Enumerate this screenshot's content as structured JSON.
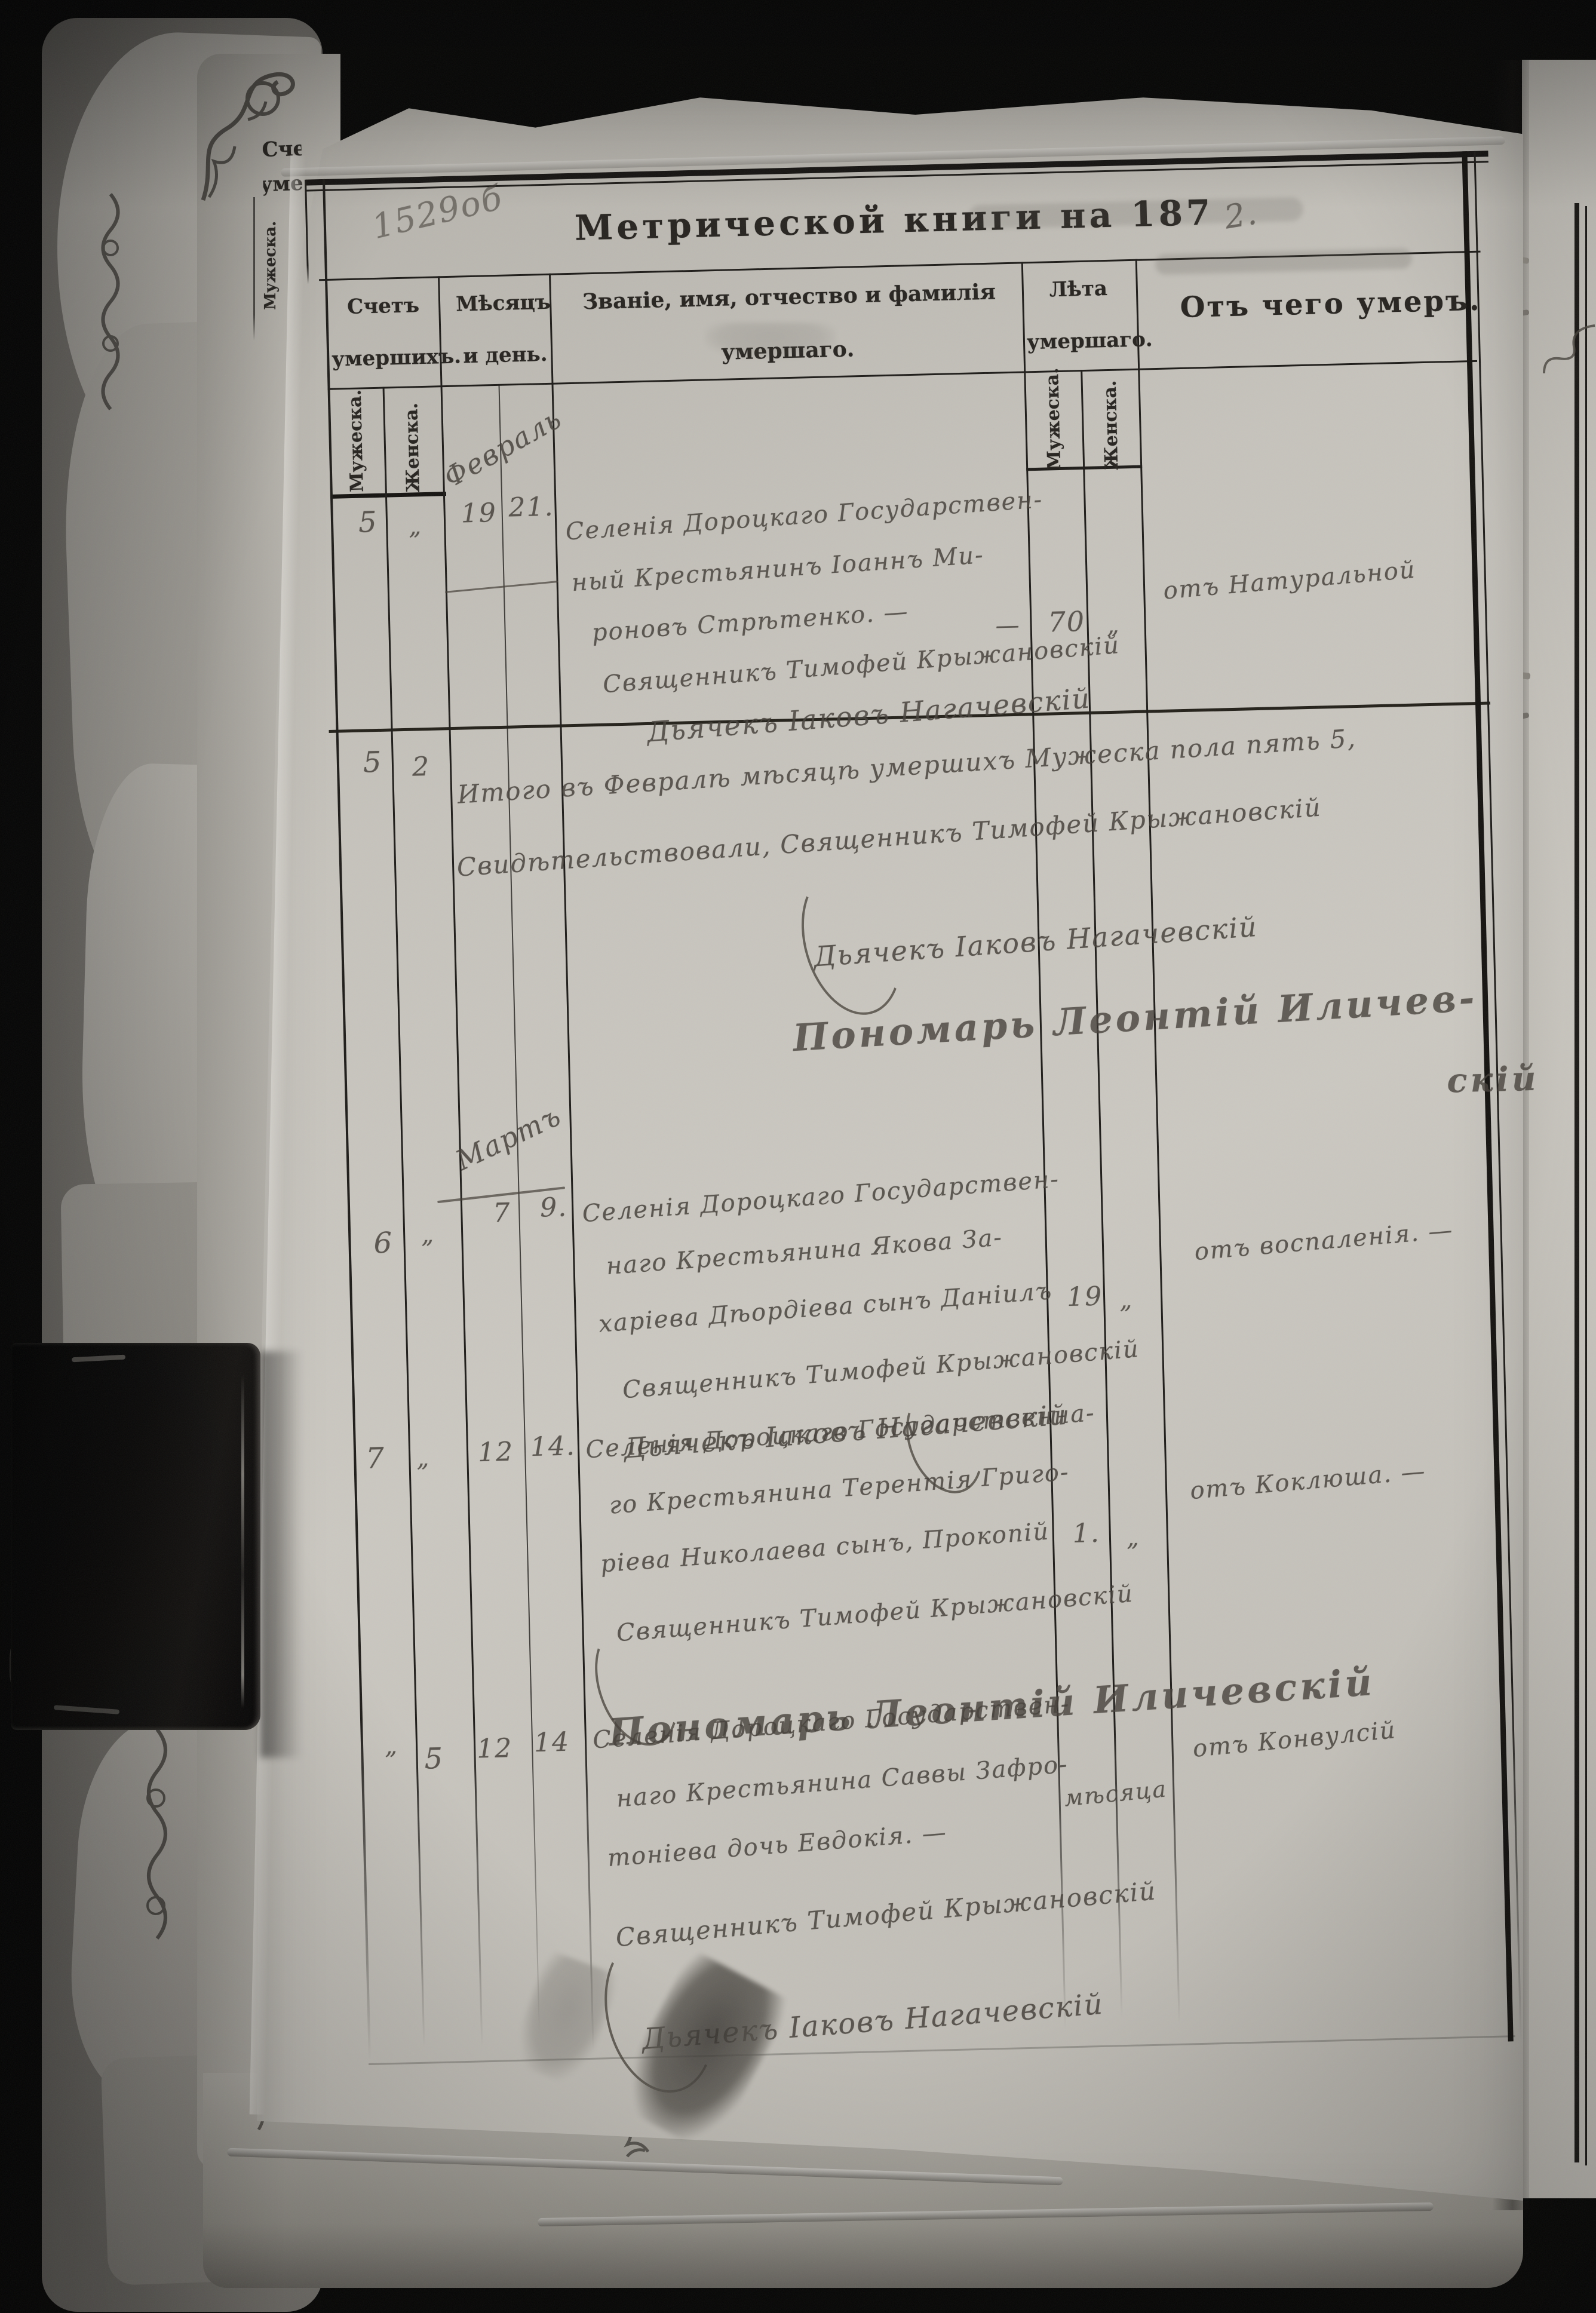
{
  "document_type": "metrical-book-death-register-photo",
  "page": {
    "folio_mark": "1529об",
    "title": "Метрической книги на 187",
    "title_year_handwritten": "2."
  },
  "header": {
    "count_l1": "Счетъ",
    "count_l2": "умершихъ.",
    "date_l1": "Мѣсяцъ",
    "date_l2": "и день.",
    "name_l1": "Званіе, имя, отчество и фамилія",
    "name_l2": "умершаго.",
    "age_l1": "Лѣта",
    "age_l2": "умершаго.",
    "cause": "Отъ чего умеръ.",
    "sub_male": "Мужеска.",
    "sub_female": "Женска."
  },
  "months": {
    "february": "Февраль",
    "march": "Мартъ"
  },
  "entries": {
    "feb1": {
      "no_male": "5",
      "no_female": "„",
      "day1": "19",
      "day2": "21.",
      "l1": "Селенія Дороцкаго Государствен-",
      "l2": "ный Крестьянинъ Іоаннъ Ми-",
      "l3": "роновъ Стрѣтенко. —",
      "dash": "—",
      "age_male": "70",
      "age_female": "„",
      "cause": "отъ Натуральной",
      "priest": "Священникъ Тимофей Крыжановскій",
      "clerk": "Дьячекъ Іаковъ Нагачевскій"
    },
    "feb_total": {
      "no_male": "5",
      "no_female": "2",
      "l1": "Итого въ Февралѣ мѣсяцѣ умершихъ Мужеска пола пять 5,",
      "l2": "Свидѣтельствовали, Священникъ Тимофей Крыжановскій",
      "clerk": "Дьячекъ Іаковъ Нагачевскій",
      "sexton_l1": "Пономарь Леонтій Иличев-",
      "sexton_l2": "скій"
    },
    "mar1": {
      "no_male": "6",
      "no_female": "„",
      "day1": "7",
      "day2": "9.",
      "l1": "Селенія Дороцкаго Государствен-",
      "l2": "наго Крестьянина Якова За-",
      "l3": "харіева Дѣордіева сынъ Даніилъ",
      "age_male": "19",
      "age_female": "„",
      "cause": "отъ воспаленія. —",
      "priest": "Священникъ Тимофей Крыжановскій",
      "clerk": "Дьячекъ Іаковъ Нагачевскій"
    },
    "mar2": {
      "no_male": "7",
      "no_female": "„",
      "day1": "12",
      "day2": "14.",
      "l1": "Селенія Дороцкаго Государственна-",
      "l2": "го Крестьянина Терентія Григо-",
      "l3": "ріева Николаева сынъ, Прокопій",
      "age_male": "1.",
      "age_female": "„",
      "cause": "отъ Коклюша. —",
      "priest": "Священникъ Тимофей Крыжановскій",
      "sexton": "Пономарь Леонтій Иличевскій"
    },
    "mar3": {
      "no_male": "„",
      "no_female": "5",
      "day1": "12",
      "day2": "14",
      "l1": "Селенія Дороцкаго Государствен-",
      "l2": "наго Крестьянина Саввы Зафро-",
      "l3": "тоніева дочь Евдокія. —",
      "age_written": "мѣсяца",
      "cause": "отъ Конвулсій",
      "priest": "Священникъ Тимофей Крыжановскій",
      "clerk": "Дьячекъ Іаковъ Нагачевскій"
    }
  },
  "colors": {
    "background": "#060605",
    "paper": "#c6c3bc",
    "printed_ink": "#26231f",
    "handwriting_ink": "#45403a",
    "clip": "#0b0a09"
  }
}
